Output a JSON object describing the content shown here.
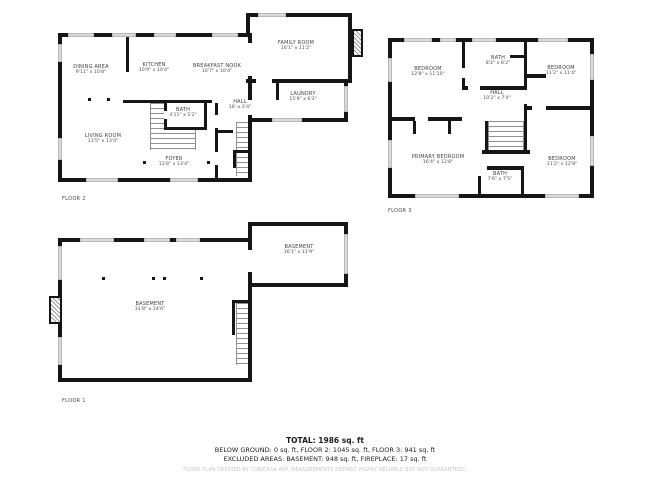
{
  "floors": [
    {
      "id": "floor2",
      "label": "FLOOR 2",
      "rooms": [
        {
          "name": "DINING AREA",
          "dims": "9'11\" x 10'8\""
        },
        {
          "name": "KITCHEN",
          "dims": "10'9\" x 10'4\""
        },
        {
          "name": "BREAKFAST NOOK",
          "dims": "10'7\" x 10'4\""
        },
        {
          "name": "FAMILY ROOM",
          "dims": "16'1\" x 11'2\""
        },
        {
          "name": "LAUNDRY",
          "dims": "15'9\" x 6'3\""
        },
        {
          "name": "BATH",
          "dims": "4'11\" x 5'2\""
        },
        {
          "name": "HALL",
          "dims": "16' x 3'4\""
        },
        {
          "name": "LIVING ROOM",
          "dims": "13'5\" x 13'4\""
        },
        {
          "name": "FOYER",
          "dims": "12'8\" x 13'4\""
        }
      ]
    },
    {
      "id": "floor3",
      "label": "FLOOR 3",
      "rooms": [
        {
          "name": "BEDROOM",
          "dims": "12'8\" x 11'10\""
        },
        {
          "name": "BATH",
          "dims": "8'2\" x 8'2\""
        },
        {
          "name": "BEDROOM",
          "dims": "11'2\" x 11'4\""
        },
        {
          "name": "HALL",
          "dims": "10'2\" x 7'4\""
        },
        {
          "name": "PRIMARY BEDROOM",
          "dims": "16'4\" x 12'8\""
        },
        {
          "name": "BATH",
          "dims": "7'6\" x 7'5\""
        },
        {
          "name": "BEDROOM",
          "dims": "11'2\" x 12'8\""
        }
      ]
    },
    {
      "id": "floor1",
      "label": "FLOOR 1",
      "rooms": [
        {
          "name": "BASEMENT",
          "dims": "16'1\" x 11'9\""
        },
        {
          "name": "BASEMENT",
          "dims": "31'8\" x 24'6\""
        }
      ]
    }
  ],
  "summary": {
    "total": "TOTAL: 1986 sq. ft",
    "line1": "BELOW GROUND: 0 sq. ft, FLOOR 2: 1045 sq. ft, FLOOR 3: 941 sq. ft",
    "line2": "EXCLUDED AREAS: BASEMENT: 948 sq. ft, FIREPLACE: 17 sq. ft",
    "disclaimer": "FLOOR PLAN CREATED BY CUBICASA APP. MEASUREMENTS DEEMED HIGHLY RELIABLE BUT NOT GUARANTEED."
  },
  "colors": {
    "wall": "#161616",
    "window": "#d9d9d9",
    "stair_stripe": "#8f8f8f",
    "text": "#3f3f3f",
    "disclaimer": "#c6c5c5"
  }
}
